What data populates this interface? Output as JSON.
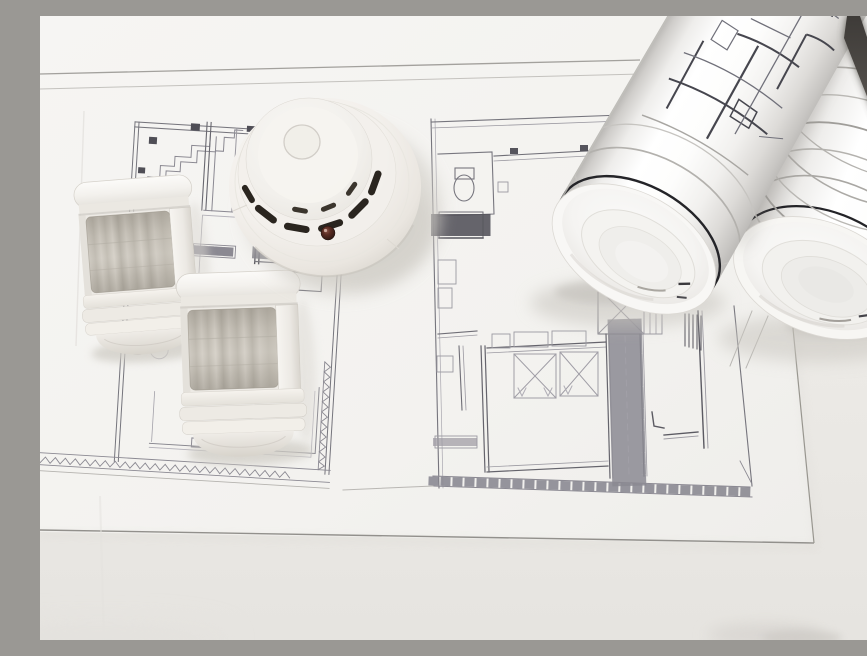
{
  "scene": {
    "alt": "Two white PIR motion sensors and a round smoke detector lying on large architectural floor-plan sheets next to two rolled-up blueprint rolls",
    "objects": [
      {
        "name": "floor-plan-left",
        "kind": "floor plan drawing"
      },
      {
        "name": "floor-plan-center",
        "kind": "floor plan drawing"
      },
      {
        "name": "motion-sensor-top",
        "kind": "PIR motion sensor"
      },
      {
        "name": "motion-sensor-bottom",
        "kind": "PIR motion sensor"
      },
      {
        "name": "smoke-detector",
        "kind": "smoke detector"
      },
      {
        "name": "blueprint-roll-front",
        "kind": "rolled blueprint"
      },
      {
        "name": "blueprint-roll-back",
        "kind": "rolled blueprint"
      }
    ],
    "counts": {
      "motion_sensors": 2,
      "blueprint_rolls": 2,
      "floor_plans": 2
    },
    "colors": {
      "paper": "#f3f2ef",
      "paper_under": "#eae8e4",
      "plan_line_light": "#9b99a1",
      "plan_line_dark": "#5d5c64",
      "device_white": "#f3f1ed",
      "lens_gray": "#c7c2b8",
      "vent_dark": "#2a251f",
      "led_dark": "#3a211a",
      "gap_dark": "#47433f",
      "print_black": "#232327"
    }
  }
}
